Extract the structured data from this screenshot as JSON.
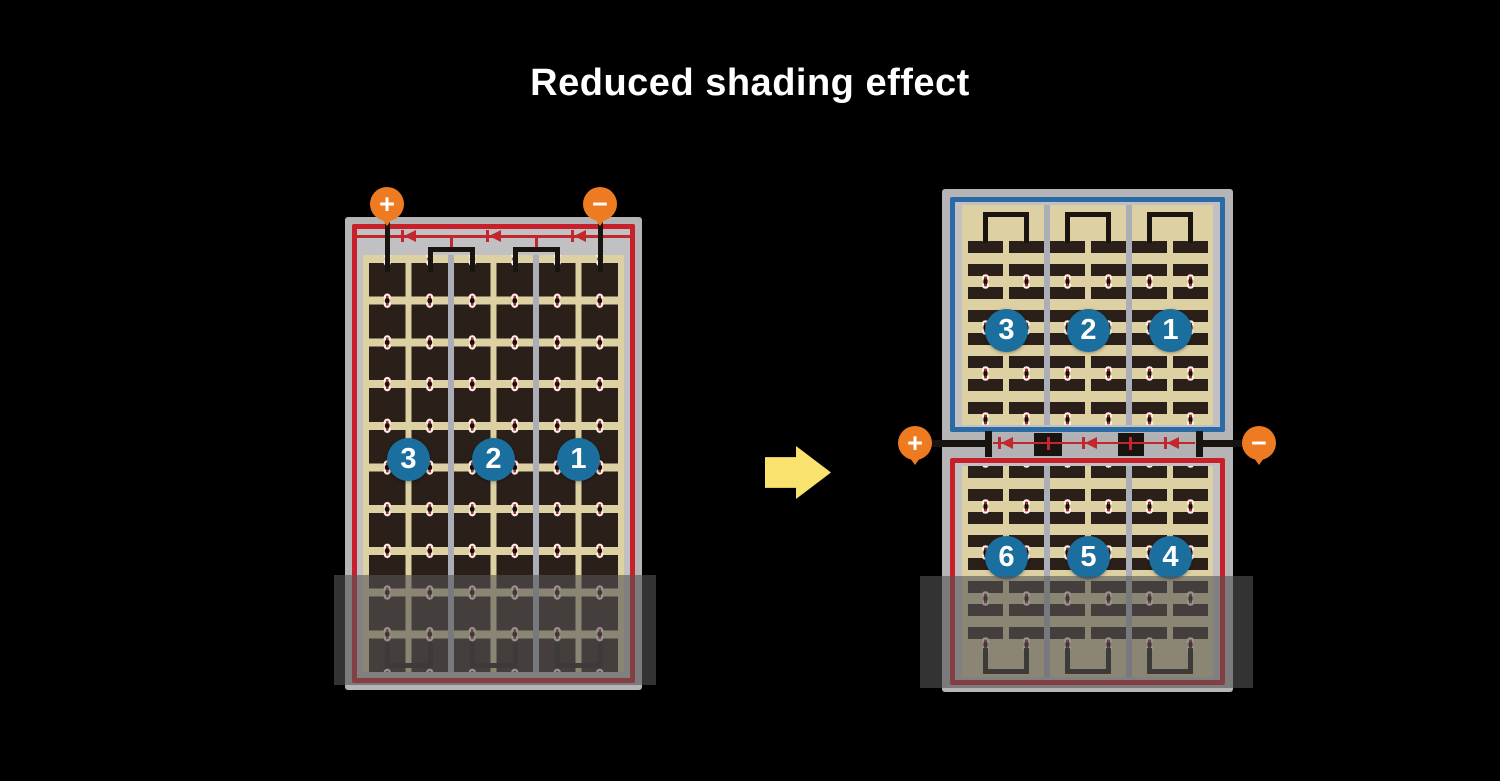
{
  "title": "Reduced shading effect",
  "colors": {
    "background": "#000000",
    "title_text": "#ffffff",
    "terminal_orange": "#ee7b21",
    "string_badge_blue": "#1b6f9e",
    "module_border_red": "#c8202a",
    "module_border_blue": "#2a6aa5",
    "diode_red": "#c1272d",
    "cell_dark": "#2b1f19",
    "cell_field_tan": "#ddd0a2",
    "frame_gray": "#b5b4b6",
    "arrow_yellow": "#fae26e"
  },
  "left_module": {
    "terminals": {
      "positive": "+",
      "negative": "−"
    },
    "string_labels": [
      "3",
      "2",
      "1"
    ],
    "columns": 6,
    "rows": 10,
    "bypass_diodes": 3
  },
  "right_module": {
    "terminals": {
      "positive": "+",
      "negative": "−"
    },
    "top_string_labels": [
      "3",
      "2",
      "1"
    ],
    "bottom_string_labels": [
      "6",
      "5",
      "4"
    ],
    "columns": 6,
    "strip_rows_per_half": 8,
    "bypass_diodes": 3
  }
}
